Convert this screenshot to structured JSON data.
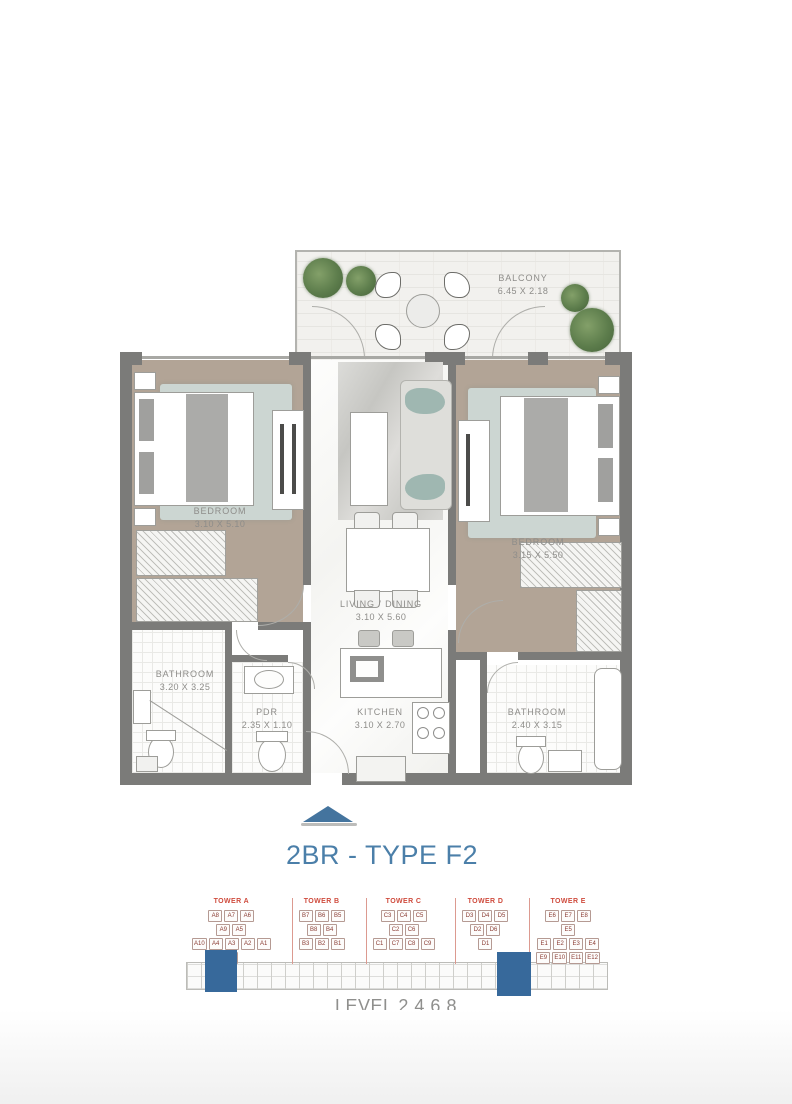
{
  "page": {
    "title": "2BR - TYPE F2",
    "level_label": "LEVEL 2,4,6,8"
  },
  "colors": {
    "accent_blue": "#4b7fa9",
    "keyplan_red": "#cf4b3d",
    "keyplan_unit_text": "#8a3c33",
    "wall_gray": "#7b7b79",
    "highlight_blue": "#37699b",
    "bedroom_floor": "#b2a496",
    "rug": "#ccd6d2"
  },
  "rooms": {
    "balcony": {
      "name": "BALCONY",
      "dims": "6.45 X 2.18"
    },
    "bedroom_1": {
      "name": "BEDROOM",
      "dims": "3.10 X 5.10"
    },
    "bedroom_2": {
      "name": "BEDROOM",
      "dims": "3.15 X 5.50"
    },
    "living_dining": {
      "name": "LIVING / DINING",
      "dims": "3.10 X 5.60"
    },
    "bathroom_1": {
      "name": "BATHROOM",
      "dims": "3.20 X 3.25"
    },
    "powder_room": {
      "name": "PDR",
      "dims": "2.35 X 1.10"
    },
    "kitchen": {
      "name": "KITCHEN",
      "dims": "3.10 X 2.70"
    },
    "bathroom_2": {
      "name": "BATHROOM",
      "dims": "2.40 X 3.15"
    }
  },
  "key_plan": {
    "towers": [
      {
        "label": "TOWER A",
        "highlighted": true,
        "rows": [
          [
            "A8",
            "A7",
            "A6"
          ],
          [
            "A9",
            "A5"
          ],
          [
            "A10",
            "A4",
            "A3",
            "A2",
            "A1"
          ],
          [
            "A11"
          ]
        ]
      },
      {
        "label": "TOWER B",
        "highlighted": false,
        "rows": [
          [
            "B7",
            "B6",
            "B5"
          ],
          [
            "B8",
            "B4"
          ],
          [
            "B3",
            "B2",
            "B1"
          ]
        ]
      },
      {
        "label": "TOWER C",
        "highlighted": false,
        "rows": [
          [
            "C3",
            "C4",
            "C5"
          ],
          [
            "C2",
            "C6"
          ],
          [
            "C1",
            "C7",
            "C8",
            "C9"
          ]
        ]
      },
      {
        "label": "TOWER D",
        "highlighted": true,
        "rows": [
          [
            "D3",
            "D4",
            "D5"
          ],
          [
            "D2",
            "D6"
          ],
          [
            "D1"
          ]
        ]
      },
      {
        "label": "TOWER E",
        "highlighted": false,
        "rows": [
          [
            "E6",
            "E7",
            "E8"
          ],
          [
            "E5"
          ],
          [
            "E1",
            "E2",
            "E3",
            "E4"
          ],
          [
            "E9",
            "E10",
            "E11",
            "E12"
          ]
        ]
      }
    ]
  }
}
